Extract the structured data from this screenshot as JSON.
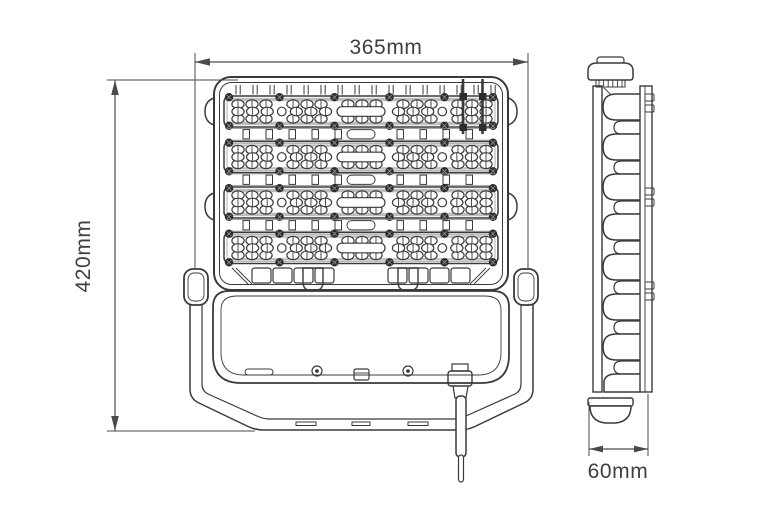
{
  "page": {
    "background": "#ffffff"
  },
  "style": {
    "line_color": "#3a3a3a",
    "detail_line_color": "#8a8a8a",
    "dimension_color": "#4a4a4a",
    "text_color": "#3f3f3f",
    "screw_color": "#2d2d2d",
    "shading_color": "#bdbdbd"
  },
  "drawing": {
    "subject": "LED flood light dimensional drawing",
    "front_view": {
      "name": "front view",
      "led_modules": 4,
      "lens_rows_per_module": 3,
      "lens_groups_per_outer_row": 5,
      "lenses_per_group": 3,
      "middle_row_positions": 18,
      "screws_per_module_edge": 6,
      "top_band_ticks": 16
    },
    "side_view": {
      "name": "side view",
      "heatsink_fins": 7,
      "collar_ticks": 6
    },
    "dimensions": {
      "width": {
        "label": "365mm"
      },
      "height": {
        "label": "420mm"
      },
      "depth": {
        "label": "60mm"
      }
    }
  }
}
